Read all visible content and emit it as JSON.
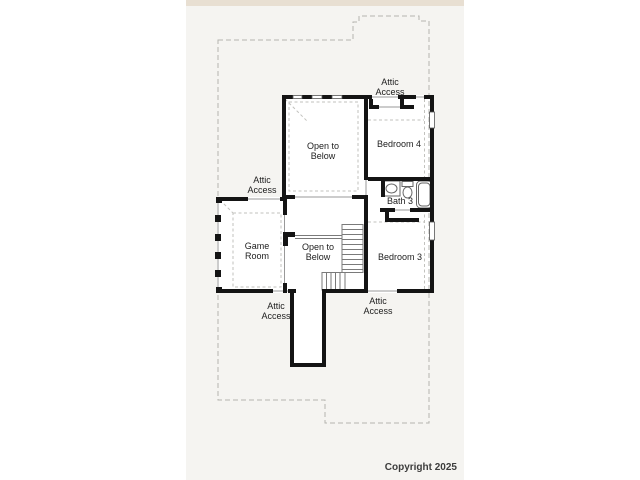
{
  "floor_plan": {
    "labels": {
      "attic_access_top": "Attic\nAccess",
      "open_to_below_upper": "Open to\nBelow",
      "bedroom_4": "Bedroom 4",
      "attic_access_mid_left": "Attic\nAccess",
      "bath_3": "Bath 3",
      "game_room": "Game\nRoom",
      "open_to_below_lower": "Open to\nBelow",
      "bedroom_3": "Bedroom 3",
      "attic_access_bottom_left": "Attic\nAccess",
      "attic_access_bottom_right": "Attic\nAccess"
    },
    "colors": {
      "wall": "#141414",
      "plat_dashed_line": "#b5b5b0",
      "ceiling_dashed_line": "#c2c2be",
      "thin_line": "#777777",
      "canvas_background": "#f5f4f1",
      "top_band": "#e8dfd2",
      "room_fill": "#ffffff"
    }
  },
  "footer": {
    "copyright_line_1": "Copyright 2025",
    "copyright_line_2": "San Antonio Board of Realtors®"
  }
}
